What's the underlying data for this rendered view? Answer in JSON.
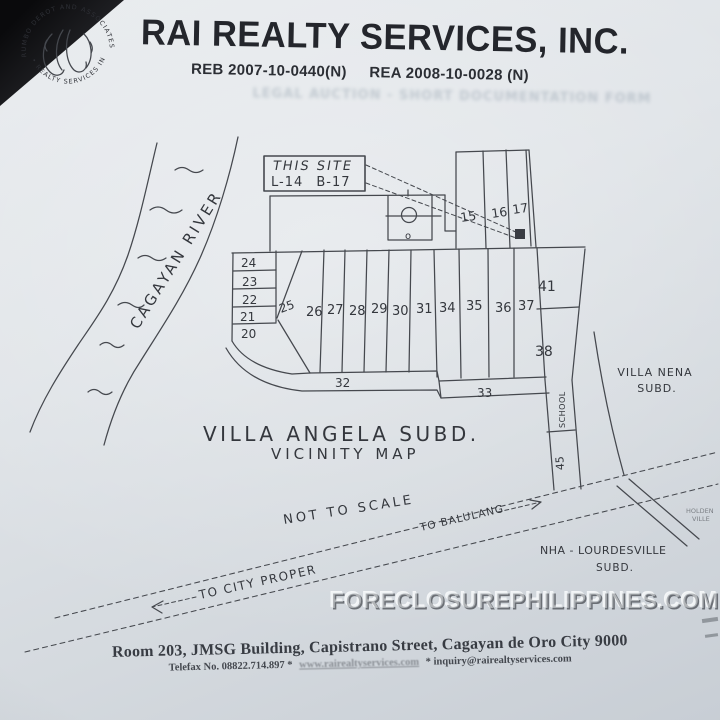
{
  "colors": {
    "paper": "#dde2e7",
    "header_ink": "#24262c",
    "map_line": "#45484e",
    "handwriting": "#34373d"
  },
  "header": {
    "company_name": "RAI REALTY SERVICES, INC.",
    "accreditation_reb": "REB 2007-10-0440(N)",
    "accreditation_rea": "REA 2008-10-0028 (N)",
    "seal_arc_top": "RUMBO DEROT AND ASSOCIATES",
    "seal_arc_bottom": "• REALTY SERVICES INC •",
    "bleed_through_text": "LEGAL AUCTION - SHORT DOCUMENTATION FORM"
  },
  "map": {
    "site_callout": {
      "line1": "THIS SITE",
      "line2": "L-14 B-17"
    },
    "river_label": "CAGAYAN RIVER",
    "top_lots": [
      "15",
      "16",
      "17"
    ],
    "stack_lots": [
      "24",
      "23",
      "22",
      "21",
      "20"
    ],
    "wedge_lot": "25",
    "row_lots": [
      "26",
      "27",
      "28",
      "29",
      "30",
      "31",
      "34",
      "35",
      "36",
      "37"
    ],
    "right_lot_upper": "41",
    "right_lot_lower": "38",
    "curve_lot": "32",
    "strip_lot": "33",
    "school_label": "SCHOOL",
    "school_lot": "45",
    "facility_mark": "o",
    "title": "VILLA ANGELA SUBD.",
    "subtitle": "VICINITY MAP",
    "neighbor_right_line1": "VILLA NENA",
    "neighbor_right_line2": "SUBD.",
    "neighbor_bottom_line1": "NHA - LOURDESVILLE",
    "neighbor_bottom_line2": "SUBD.",
    "scale_note": "NOT TO SCALE",
    "road_label_right": "TO BALULANG",
    "road_label_left": "TO CITY PROPER",
    "edge_text_line1": "HOLDEN",
    "edge_text_line2": "VILLE"
  },
  "watermark": "FORECLOSUREPHILIPPINES.COM",
  "footer": {
    "address": "Room 203, JMSG Building, Capistrano Street, Cagayan de Oro City 9000",
    "telefax": "Telefax No. 08822.714.897 *",
    "website": "www.rairealtyservices.com",
    "email": "* inquiry@rairealtyservices.com"
  }
}
